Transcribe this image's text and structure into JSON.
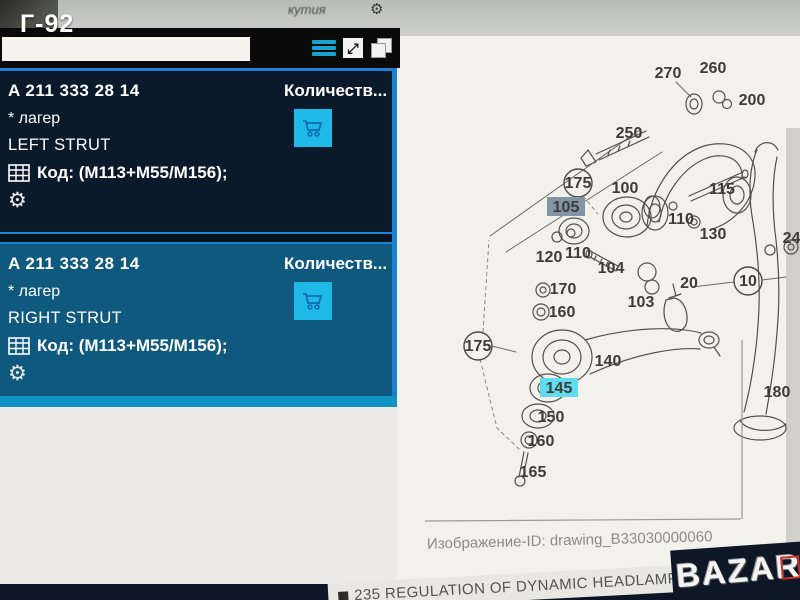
{
  "overlay": {
    "photo_tag": "Г-92",
    "watermark": "BAZAR"
  },
  "toolbar": {
    "top_hint": "кутия",
    "search_value": "",
    "icons": [
      "list-view",
      "fullscreen",
      "copy"
    ]
  },
  "parts": [
    {
      "number": "A 211 333 28 14",
      "name": "* лагер",
      "position": "LEFT STRUT",
      "code": "Код: (M113+M55/M156);",
      "qty_header": "Количеств..."
    },
    {
      "number": "A 211 333 28 14",
      "name": "* лагер",
      "position": "RIGHT STRUT",
      "code": "Код: (M113+M55/M156);",
      "qty_header": "Количеств..."
    }
  ],
  "diagram": {
    "image_id_label": "Изображение-ID: drawing_B33030000060",
    "labels": [
      {
        "t": "270",
        "x": 668,
        "y": 73
      },
      {
        "t": "260",
        "x": 713,
        "y": 68
      },
      {
        "t": "250",
        "x": 629,
        "y": 133
      },
      {
        "t": "200",
        "x": 752,
        "y": 100
      },
      {
        "t": "175",
        "x": 578,
        "y": 183,
        "v": "circle"
      },
      {
        "t": "100",
        "x": 625,
        "y": 188
      },
      {
        "t": "105",
        "x": 566,
        "y": 207,
        "v": "gray"
      },
      {
        "t": "115",
        "x": 722,
        "y": 189
      },
      {
        "t": "110",
        "x": 681,
        "y": 219
      },
      {
        "t": "130",
        "x": 713,
        "y": 234
      },
      {
        "t": "120",
        "x": 549,
        "y": 257
      },
      {
        "t": "110",
        "x": 578,
        "y": 253
      },
      {
        "t": "104",
        "x": 611,
        "y": 268
      },
      {
        "t": "103",
        "x": 641,
        "y": 302
      },
      {
        "t": "170",
        "x": 563,
        "y": 289
      },
      {
        "t": "160",
        "x": 562,
        "y": 312
      },
      {
        "t": "175",
        "x": 478,
        "y": 346,
        "v": "circle"
      },
      {
        "t": "140",
        "x": 608,
        "y": 361
      },
      {
        "t": "145",
        "x": 559,
        "y": 388,
        "v": "cyan"
      },
      {
        "t": "150",
        "x": 551,
        "y": 417
      },
      {
        "t": "160",
        "x": 541,
        "y": 441
      },
      {
        "t": "165",
        "x": 533,
        "y": 472
      },
      {
        "t": "20",
        "x": 689,
        "y": 283
      },
      {
        "t": "10",
        "x": 748,
        "y": 281,
        "v": "circle"
      },
      {
        "t": "180",
        "x": 777,
        "y": 392
      },
      {
        "t": "240",
        "x": 796,
        "y": 238
      }
    ]
  },
  "footer": {
    "regulation_text": "235 REGULATION OF DYNAMIC HEADLAMP RANGE CONTROL"
  }
}
